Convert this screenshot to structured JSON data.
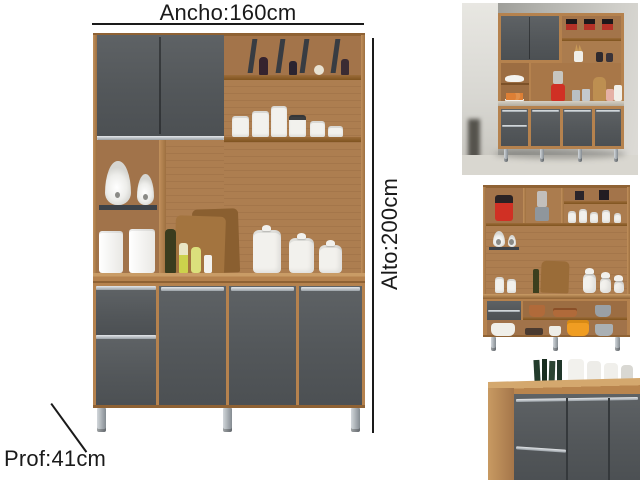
{
  "annotations": {
    "width_label": "Ancho:160cm",
    "height_label": "Alto:200cm",
    "depth_label": "Prof:41cm"
  },
  "colors": {
    "ink": "#1a1a1a",
    "wood": "#b5824e",
    "wood_dark": "#8f6234",
    "wood_light": "#c99c66",
    "back_slat": "#ad7e50",
    "door_gray": "#55585b",
    "door_gray_deep": "#4b4e51",
    "silver": "#c7ccd1",
    "chrome": "#9aa1a7",
    "dark_shelf": "#3d4248",
    "white_item": "#f2f1ed",
    "wall_gray": "#b9b8b3",
    "floor_gray": "#d9d7d0",
    "accent_red": "#d03024",
    "accent_orange": "#f09d22",
    "accent_copper": "#b06a3a",
    "fruit_orange": "#dd7f35"
  },
  "gallery": {
    "main_image": "kitchen-cabinet-dimension-view",
    "thumbnails": [
      {
        "name": "styled-room-view"
      },
      {
        "name": "open-shelves-view"
      },
      {
        "name": "base-doors-closeup"
      }
    ]
  }
}
